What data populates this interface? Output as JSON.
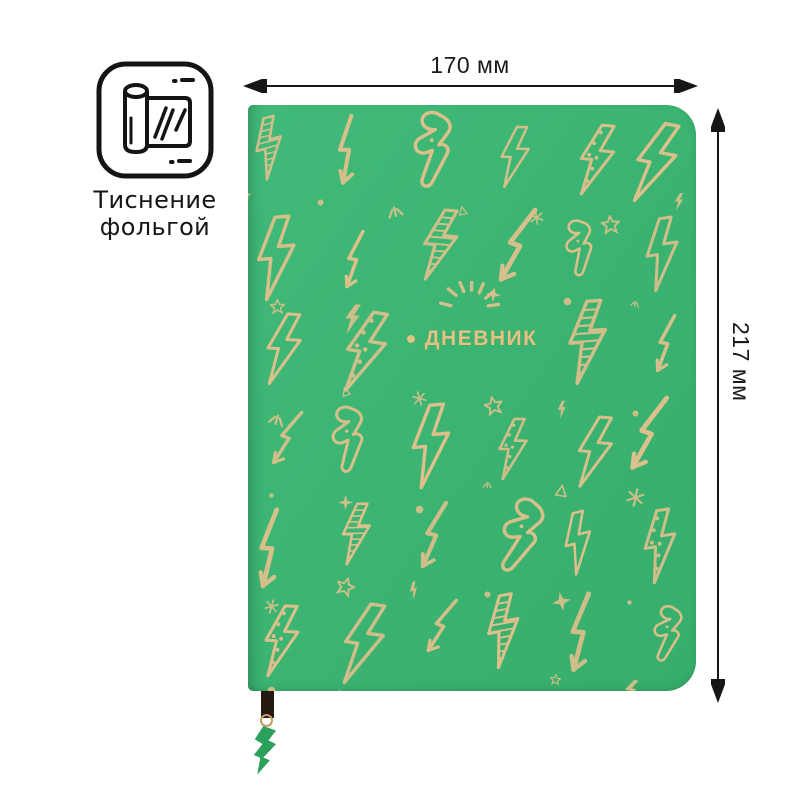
{
  "foil_badge": {
    "icon": "foil-stamping-icon",
    "label_line1": "Тиснение",
    "label_line2": "фольгой"
  },
  "dimensions": {
    "width_label": "170 мм",
    "height_label": "217 мм",
    "annotation_color": "#1a1a1a"
  },
  "notebook": {
    "title": "ДНЕВНИК",
    "cover_color": "#3cb472",
    "foil_color": "#dcc08c",
    "title_color": "#e3c285",
    "pattern": "gold-foil-lightning-bolts-and-stars",
    "bookmark": {
      "ribbon_color": "#241a12",
      "ring_color": "#c49b66",
      "charm": "lightning-bolt-charm",
      "charm_color": "#2ba15c"
    }
  }
}
